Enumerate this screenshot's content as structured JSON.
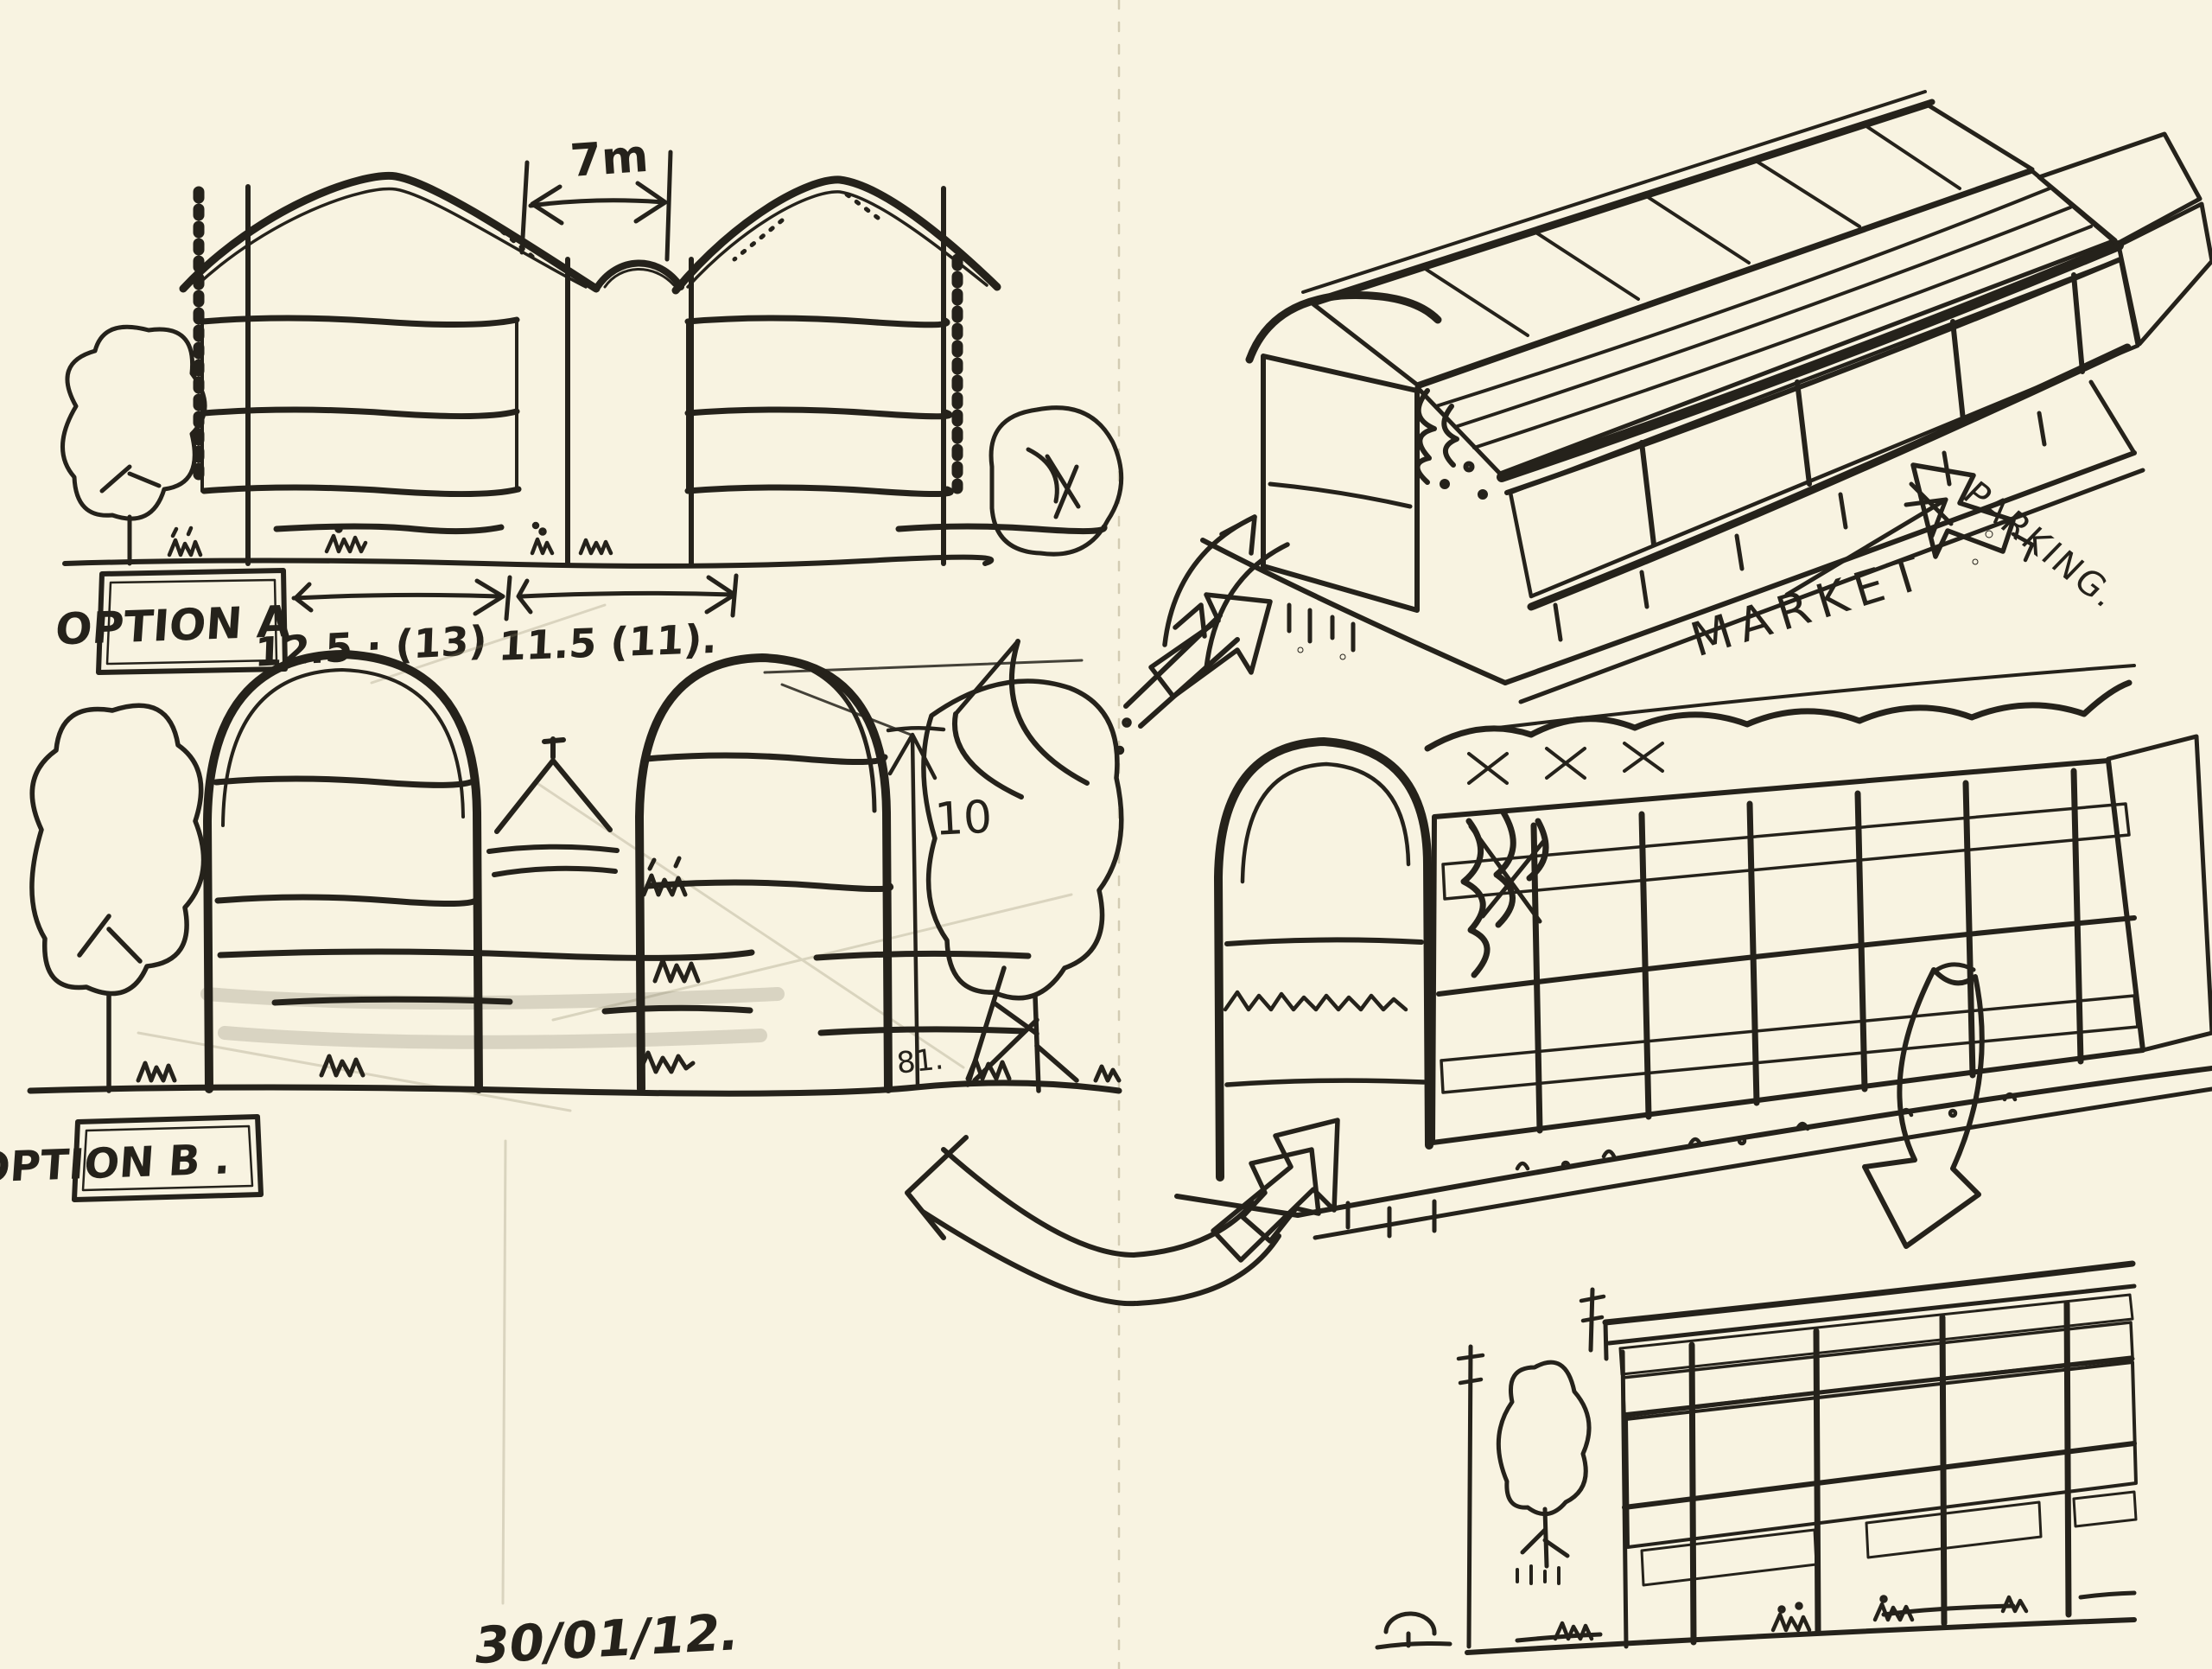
{
  "sketchbook": {
    "date_note": "30/01/12.",
    "left_page": {
      "option_a": {
        "label": "OPTION A",
        "roof_gap_dimension": "7m",
        "left_bay_dimension": "12.5 · (13)",
        "right_bay_dimension": "11.5 (11)."
      },
      "option_b": {
        "label": "OPTION B .",
        "height_dimension": "10",
        "ground_note": "81."
      }
    },
    "right_page": {
      "market_label": "MARKET",
      "parking_label": "PARKING."
    },
    "colors": {
      "paper": "#f8f3e1",
      "ink": "#25221b",
      "marker_yellow": "#f6bc4e",
      "marker_yellow_light": "#fad98b",
      "pencil": "#b7af97"
    }
  }
}
